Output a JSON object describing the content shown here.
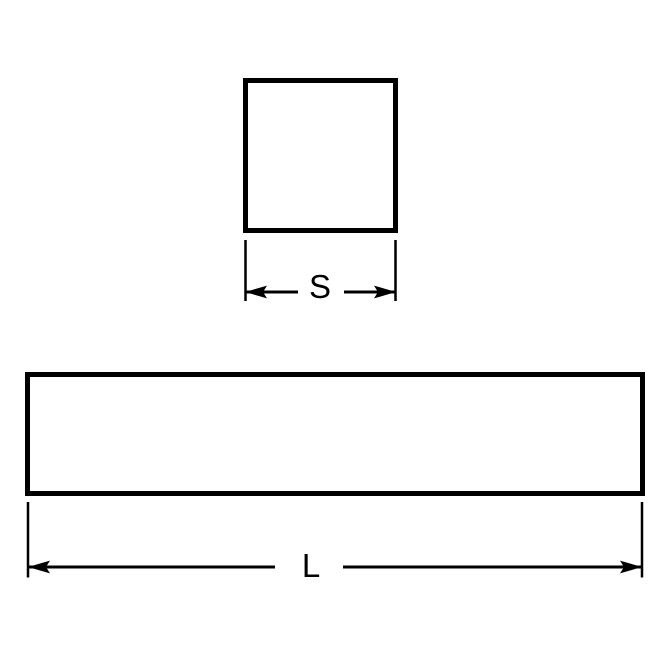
{
  "diagram": {
    "kind": "technical-dimension-drawing",
    "colors": {
      "line": "#000000",
      "background": "#ffffff"
    },
    "cross_section_view": {
      "shape": "square",
      "dimension_label": "S"
    },
    "side_view": {
      "shape": "rectangle",
      "dimension_label": "L"
    }
  }
}
